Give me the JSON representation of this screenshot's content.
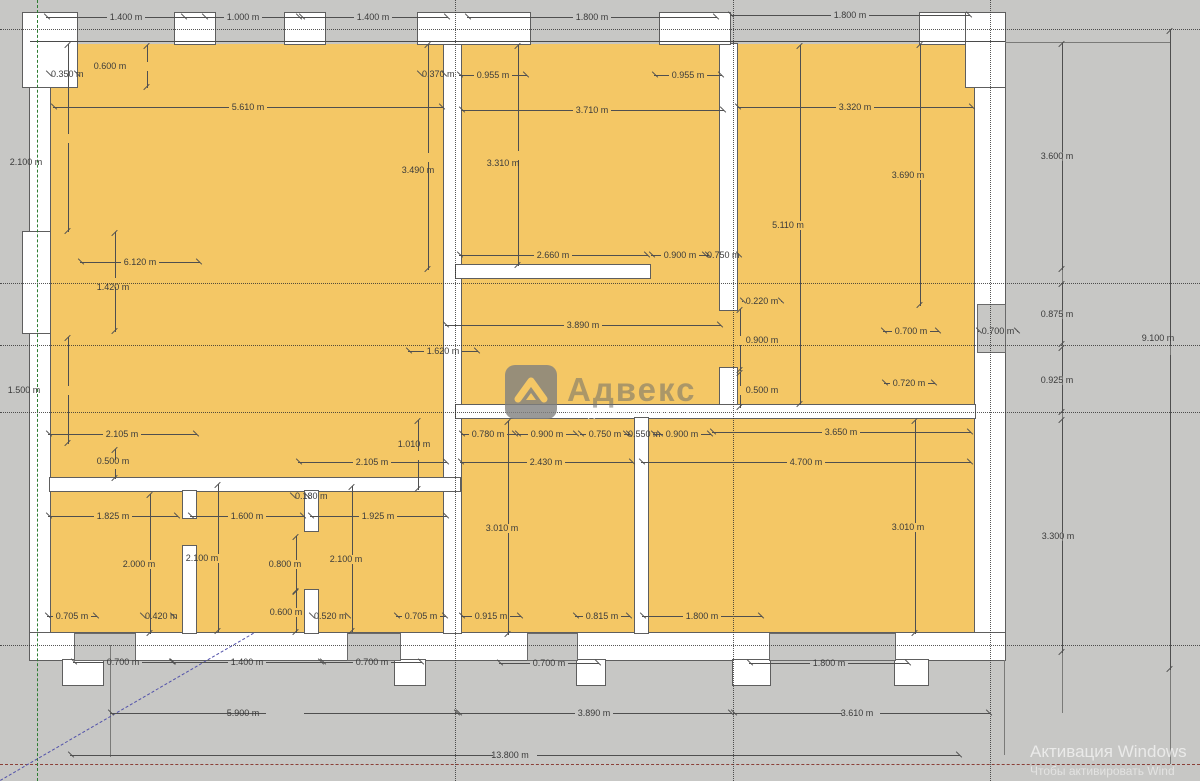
{
  "watermark": {
    "title": "Адвекс",
    "subtitle": "НЕДВИЖИМОСТЬ"
  },
  "activation": {
    "line1": "Активация Windows",
    "line2": "Чтобы активировать Wind"
  },
  "plan": {
    "colors": {
      "room": "#f4c765",
      "wall": "#ffffff",
      "ground": "#c7c7c5",
      "dim_text": "#3b3b3b"
    },
    "rooms": [
      {
        "x": 50,
        "y": 44,
        "w": 925,
        "h": 589
      }
    ],
    "walls": [
      {
        "x": 30,
        "y": 42,
        "w": 20,
        "h": 618
      },
      {
        "x": 975,
        "y": 42,
        "w": 30,
        "h": 618
      },
      {
        "x": 30,
        "y": 633,
        "w": 975,
        "h": 27
      },
      {
        "x": 444,
        "y": 44,
        "w": 17,
        "h": 589
      },
      {
        "x": 456,
        "y": 265,
        "w": 194,
        "h": 13
      },
      {
        "x": 720,
        "y": 44,
        "w": 17,
        "h": 266
      },
      {
        "x": 720,
        "y": 368,
        "w": 17,
        "h": 50
      },
      {
        "x": 456,
        "y": 405,
        "w": 519,
        "h": 13
      },
      {
        "x": 635,
        "y": 418,
        "w": 13,
        "h": 215
      },
      {
        "x": 50,
        "y": 478,
        "w": 410,
        "h": 13
      },
      {
        "x": 183,
        "y": 491,
        "w": 13,
        "h": 27
      },
      {
        "x": 183,
        "y": 546,
        "w": 13,
        "h": 87
      },
      {
        "x": 305,
        "y": 491,
        "w": 13,
        "h": 40
      },
      {
        "x": 305,
        "y": 590,
        "w": 13,
        "h": 43
      },
      {
        "x": 23,
        "y": 13,
        "w": 54,
        "h": 74
      },
      {
        "x": 175,
        "y": 13,
        "w": 40,
        "h": 31
      },
      {
        "x": 285,
        "y": 13,
        "w": 40,
        "h": 31
      },
      {
        "x": 418,
        "y": 13,
        "w": 112,
        "h": 31
      },
      {
        "x": 660,
        "y": 13,
        "w": 70,
        "h": 31
      },
      {
        "x": 920,
        "y": 13,
        "w": 46,
        "h": 31
      },
      {
        "x": 966,
        "y": 13,
        "w": 39,
        "h": 74
      },
      {
        "x": 23,
        "y": 232,
        "w": 27,
        "h": 101
      },
      {
        "x": 63,
        "y": 660,
        "w": 40,
        "h": 25
      },
      {
        "x": 395,
        "y": 660,
        "w": 30,
        "h": 25
      },
      {
        "x": 577,
        "y": 660,
        "w": 28,
        "h": 25
      },
      {
        "x": 733,
        "y": 660,
        "w": 37,
        "h": 25
      },
      {
        "x": 895,
        "y": 660,
        "w": 33,
        "h": 25
      }
    ],
    "patches": [
      {
        "x": 75,
        "y": 634,
        "w": 60,
        "h": 26
      },
      {
        "x": 348,
        "y": 634,
        "w": 52,
        "h": 26
      },
      {
        "x": 528,
        "y": 634,
        "w": 49,
        "h": 26
      },
      {
        "x": 770,
        "y": 634,
        "w": 125,
        "h": 26
      },
      {
        "x": 978,
        "y": 305,
        "w": 27,
        "h": 47
      }
    ],
    "guides": [
      {
        "cls": "dot-h",
        "x": 0,
        "y": 29,
        "l": 1200
      },
      {
        "cls": "dot-h",
        "x": 0,
        "y": 283,
        "l": 1200
      },
      {
        "cls": "dot-h",
        "x": 0,
        "y": 345,
        "l": 1200
      },
      {
        "cls": "dot-h",
        "x": 0,
        "y": 412,
        "l": 1200
      },
      {
        "cls": "dot-h",
        "x": 0,
        "y": 645,
        "l": 1200
      },
      {
        "cls": "red-h",
        "x": 0,
        "y": 764,
        "l": 1200
      },
      {
        "cls": "dot-v",
        "x": 455,
        "y": 0,
        "l": 781
      },
      {
        "cls": "dot-v",
        "x": 733,
        "y": 0,
        "l": 781
      },
      {
        "cls": "dot-v",
        "x": 990,
        "y": 0,
        "l": 781
      },
      {
        "cls": "green-v",
        "x": 37,
        "y": 0,
        "l": 781
      }
    ],
    "lines": [
      {
        "o": "h",
        "x": 30,
        "y": 41,
        "l": 975,
        "cls": "solid2"
      },
      {
        "o": "h",
        "x": 1005,
        "y": 42,
        "l": 165,
        "cls": "solid1"
      },
      {
        "o": "v",
        "x": 1062,
        "y": 42,
        "l": 671,
        "cls": "solid1"
      },
      {
        "o": "v",
        "x": 1170,
        "y": 29,
        "l": 735,
        "cls": "solid1"
      },
      {
        "o": "v",
        "x": 110,
        "y": 645,
        "l": 112,
        "cls": "solid1"
      },
      {
        "o": "v",
        "x": 1004,
        "y": 660,
        "l": 95,
        "cls": "solid1"
      }
    ],
    "diagonal": {
      "x1": 0,
      "y1": 780,
      "x2": 253,
      "y2": 633
    },
    "dims": [
      {
        "t": "1.400 m",
        "o": "h",
        "x": 126,
        "y": 17,
        "l": 160
      },
      {
        "t": "1.000 m",
        "o": "h",
        "x": 243,
        "y": 17,
        "l": 120
      },
      {
        "t": "1.400 m",
        "o": "h",
        "x": 373,
        "y": 17,
        "l": 150
      },
      {
        "t": "1.800 m",
        "o": "h",
        "x": 592,
        "y": 17,
        "l": 250
      },
      {
        "t": "1.800 m",
        "o": "h",
        "x": 850,
        "y": 15,
        "l": 240
      },
      {
        "t": "0.350 m",
        "o": "h",
        "x": 63,
        "y": 74,
        "l": 30
      },
      {
        "t": "0.600 m",
        "o": "v",
        "x": 147,
        "y": 66,
        "l": 43,
        "dx": -37
      },
      {
        "t": "5.610 m",
        "o": "h",
        "x": 248,
        "y": 107,
        "l": 390
      },
      {
        "t": "0.370 m",
        "o": "h",
        "x": 432,
        "y": 74,
        "l": 26
      },
      {
        "t": "0.955 m",
        "o": "h",
        "x": 493,
        "y": 75,
        "l": 68
      },
      {
        "t": "0.955 m",
        "o": "h",
        "x": 688,
        "y": 75,
        "l": 68
      },
      {
        "t": "3.710 m",
        "o": "h",
        "x": 592,
        "y": 110,
        "l": 263
      },
      {
        "t": "3.320 m",
        "o": "h",
        "x": 855,
        "y": 107,
        "l": 236
      },
      {
        "t": "2.100 m",
        "o": "v",
        "x": 68,
        "y": 138,
        "l": 188,
        "dx": -42,
        "dy": 24
      },
      {
        "t": "3.490 m",
        "o": "v",
        "x": 428,
        "y": 157,
        "l": 226,
        "dx": -10,
        "dy": 13
      },
      {
        "t": "3.310 m",
        "o": "v",
        "x": 518,
        "y": 155,
        "l": 221,
        "dx": -15,
        "dy": 8
      },
      {
        "t": "3.690 m",
        "o": "v",
        "x": 920,
        "y": 175,
        "l": 262,
        "dx": -12
      },
      {
        "t": "5.110 m",
        "o": "v",
        "x": 800,
        "y": 225,
        "l": 360,
        "dx": -12
      },
      {
        "t": "6.120 m",
        "o": "h",
        "x": 140,
        "y": 262,
        "l": 120
      },
      {
        "t": "1.420 m",
        "o": "v",
        "x": 115,
        "y": 282,
        "l": 100,
        "dx": -2,
        "dy": 5
      },
      {
        "t": "2.660 m",
        "o": "h",
        "x": 553,
        "y": 255,
        "l": 189
      },
      {
        "t": "0.900 m",
        "o": "h",
        "x": 680,
        "y": 255,
        "l": 58
      },
      {
        "t": "0.750 m",
        "o": "h",
        "x": 722,
        "y": 255,
        "l": 36
      },
      {
        "t": "0.220 m",
        "o": "h",
        "x": 762,
        "y": 301,
        "l": 40
      },
      {
        "t": "0.900 m",
        "o": "v",
        "x": 740,
        "y": 340,
        "l": 62,
        "dx": 22
      },
      {
        "t": "0.500 m",
        "o": "v",
        "x": 740,
        "y": 390,
        "l": 36,
        "dx": 22
      },
      {
        "t": "3.890 m",
        "o": "h",
        "x": 583,
        "y": 325,
        "l": 276
      },
      {
        "t": "1.620 m",
        "o": "h",
        "x": 443,
        "y": 351,
        "l": 70
      },
      {
        "t": "0.700 m",
        "o": "h",
        "x": 911,
        "y": 331,
        "l": 56
      },
      {
        "t": "0.700 m",
        "o": "h",
        "x": 998,
        "y": 331,
        "l": 40
      },
      {
        "t": "0.720 m",
        "o": "h",
        "x": 909,
        "y": 383,
        "l": 51
      },
      {
        "t": "3.600 m",
        "o": "v",
        "x": 1062,
        "y": 156,
        "l": 227,
        "dx": -5
      },
      {
        "t": "0.875 m",
        "o": "v",
        "x": 1062,
        "y": 314,
        "l": 62,
        "dx": -5
      },
      {
        "t": "0.925 m",
        "o": "v",
        "x": 1062,
        "y": 380,
        "l": 66,
        "dx": -5
      },
      {
        "t": "9.100 m",
        "o": "v",
        "x": 1170,
        "y": 350,
        "l": 640,
        "dx": -12,
        "dy": -12
      },
      {
        "t": "3.300 m",
        "o": "v",
        "x": 1062,
        "y": 536,
        "l": 234,
        "dx": -4
      },
      {
        "t": "1.500 m",
        "o": "v",
        "x": 68,
        "y": 390,
        "l": 107,
        "dx": -44
      },
      {
        "t": "2.105 m",
        "o": "h",
        "x": 122,
        "y": 434,
        "l": 149
      },
      {
        "t": "0.500 m",
        "o": "v",
        "x": 115,
        "y": 464,
        "l": 30,
        "dx": -2,
        "dy": -3
      },
      {
        "t": "1.825 m",
        "o": "h",
        "x": 113,
        "y": 516,
        "l": 130
      },
      {
        "t": "1.600 m",
        "o": "h",
        "x": 247,
        "y": 516,
        "l": 114
      },
      {
        "t": "2.000 m",
        "o": "v",
        "x": 150,
        "y": 564,
        "l": 140,
        "dx": -11
      },
      {
        "t": "2.100 m",
        "o": "v",
        "x": 218,
        "y": 558,
        "l": 148,
        "dx": -16
      },
      {
        "t": "0.705 m",
        "o": "h",
        "x": 72,
        "y": 616,
        "l": 50
      },
      {
        "t": "0.420 m",
        "o": "h",
        "x": 158,
        "y": 616,
        "l": 32
      },
      {
        "t": "0.800 m",
        "o": "v",
        "x": 296,
        "y": 564,
        "l": 56,
        "dx": -11
      },
      {
        "t": "0.600 m",
        "o": "v",
        "x": 296,
        "y": 612,
        "l": 42,
        "dx": -10
      },
      {
        "t": "0.180 m",
        "o": "h",
        "x": 300,
        "y": 496,
        "l": 16
      },
      {
        "t": "1.010 m",
        "o": "v",
        "x": 418,
        "y": 455,
        "l": 70,
        "dx": -4,
        "dy": -11
      },
      {
        "t": "2.105 m",
        "o": "h",
        "x": 372,
        "y": 462,
        "l": 149
      },
      {
        "t": "1.925 m",
        "o": "h",
        "x": 378,
        "y": 516,
        "l": 137
      },
      {
        "t": "2.100 m",
        "o": "v",
        "x": 352,
        "y": 559,
        "l": 146,
        "dx": -6
      },
      {
        "t": "0.520 m",
        "o": "h",
        "x": 330,
        "y": 616,
        "l": 38
      },
      {
        "t": "0.705 m",
        "o": "h",
        "x": 421,
        "y": 616,
        "l": 50
      },
      {
        "t": "0.780 m",
        "o": "h",
        "x": 488,
        "y": 434,
        "l": 55
      },
      {
        "t": "0.900 m",
        "o": "h",
        "x": 547,
        "y": 434,
        "l": 60
      },
      {
        "t": "0.750 m",
        "o": "h",
        "x": 605,
        "y": 434,
        "l": 50
      },
      {
        "t": "0.550 m",
        "o": "h",
        "x": 643,
        "y": 434,
        "l": 36
      },
      {
        "t": "0.900 m",
        "o": "h",
        "x": 682,
        "y": 434,
        "l": 58
      },
      {
        "t": "2.430 m",
        "o": "h",
        "x": 546,
        "y": 462,
        "l": 173
      },
      {
        "t": "3.010 m",
        "o": "v",
        "x": 508,
        "y": 528,
        "l": 214,
        "dx": -6
      },
      {
        "t": "0.915 m",
        "o": "h",
        "x": 491,
        "y": 616,
        "l": 60
      },
      {
        "t": "0.815 m",
        "o": "h",
        "x": 602,
        "y": 616,
        "l": 55
      },
      {
        "t": "1.800 m",
        "o": "h",
        "x": 702,
        "y": 616,
        "l": 120
      },
      {
        "t": "3.650 m",
        "o": "h",
        "x": 841,
        "y": 432,
        "l": 259
      },
      {
        "t": "4.700 m",
        "o": "h",
        "x": 806,
        "y": 462,
        "l": 330
      },
      {
        "t": "3.010 m",
        "o": "v",
        "x": 915,
        "y": 527,
        "l": 214,
        "dx": -7
      },
      {
        "t": "0.700 m",
        "o": "h",
        "x": 123,
        "y": 662,
        "l": 100
      },
      {
        "t": "1.400 m",
        "o": "h",
        "x": 247,
        "y": 662,
        "l": 150
      },
      {
        "t": "0.700 m",
        "o": "h",
        "x": 372,
        "y": 662,
        "l": 100
      },
      {
        "t": "0.700 m",
        "o": "h",
        "x": 549,
        "y": 663,
        "l": 100
      },
      {
        "t": "1.800 m",
        "o": "h",
        "x": 829,
        "y": 663,
        "l": 160
      },
      {
        "t": "5.900 m",
        "o": "h",
        "x": 285,
        "y": 713,
        "l": 350,
        "dx": -42
      },
      {
        "t": "3.890 m",
        "o": "h",
        "x": 594,
        "y": 713,
        "l": 276
      },
      {
        "t": "3.610 m",
        "o": "h",
        "x": 861,
        "y": 713,
        "l": 257,
        "dx": -4
      },
      {
        "t": "13.800 m",
        "o": "h",
        "x": 515,
        "y": 755,
        "l": 890,
        "dx": -5
      }
    ]
  }
}
